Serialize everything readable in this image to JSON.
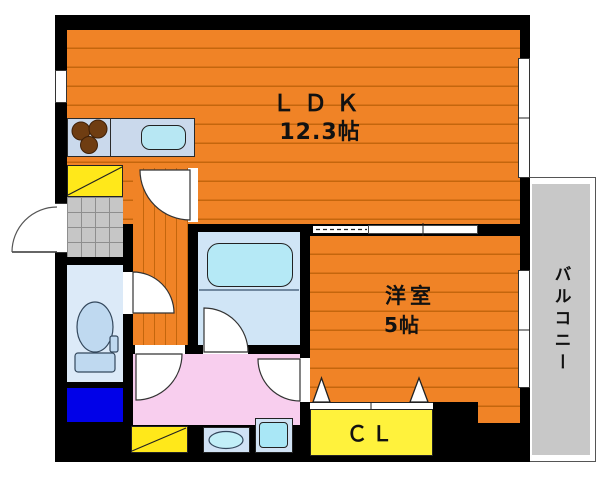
{
  "floorplan": {
    "rooms": {
      "ldk": {
        "name": "ＬＤＫ",
        "size": "12.3帖"
      },
      "western": {
        "name": "洋室",
        "size": "5帖"
      },
      "balcony": {
        "name": "バルコニー"
      },
      "closet": {
        "name": "ＣＬ"
      }
    },
    "fixtures": [
      "stove-burners",
      "kitchen-sink",
      "shoe-cabinet",
      "entrance-tiles",
      "toilet",
      "bathtub",
      "washing-machine-space",
      "vanity-sink",
      "washer-pan"
    ],
    "colors": {
      "floor_orange": "#f08326",
      "floor_stripe": "#c4660d",
      "wall_black": "#000000",
      "balcony_gray": "#c8c8c8",
      "counter_blue": "#cad9ec",
      "water_cyan": "#b5e9f6",
      "toilet_room_blue": "#dceaf8",
      "washroom_pink": "#f8ceee",
      "closet_yellow": "#fff23c",
      "cabinet_yellow": "#ffe81a",
      "box_blue": "#0101e8"
    }
  }
}
